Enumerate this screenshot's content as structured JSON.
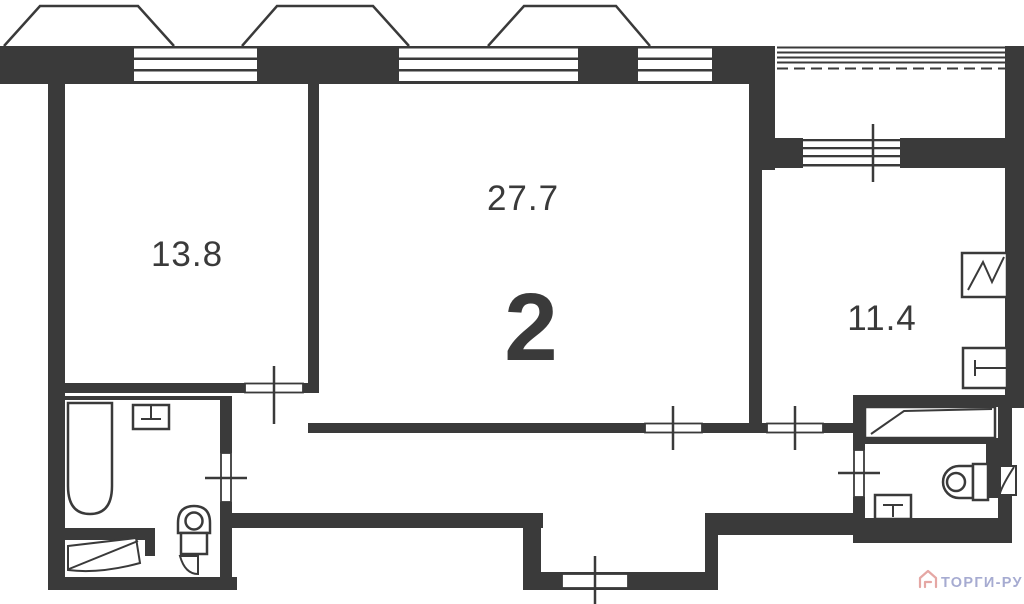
{
  "floor_plan": {
    "plan_number": "2",
    "rooms": [
      {
        "name": "room-left",
        "area": "13.8"
      },
      {
        "name": "room-center",
        "area": "27.7"
      },
      {
        "name": "kitchen",
        "area": "11.4"
      }
    ],
    "colors": {
      "wall": "#3a3a3a",
      "background": "#ffffff",
      "watermark_text": "#a6abd1",
      "watermark_icon": "#e5a7a4"
    }
  },
  "watermark": {
    "brand": "ТОРГИ-РУ"
  }
}
